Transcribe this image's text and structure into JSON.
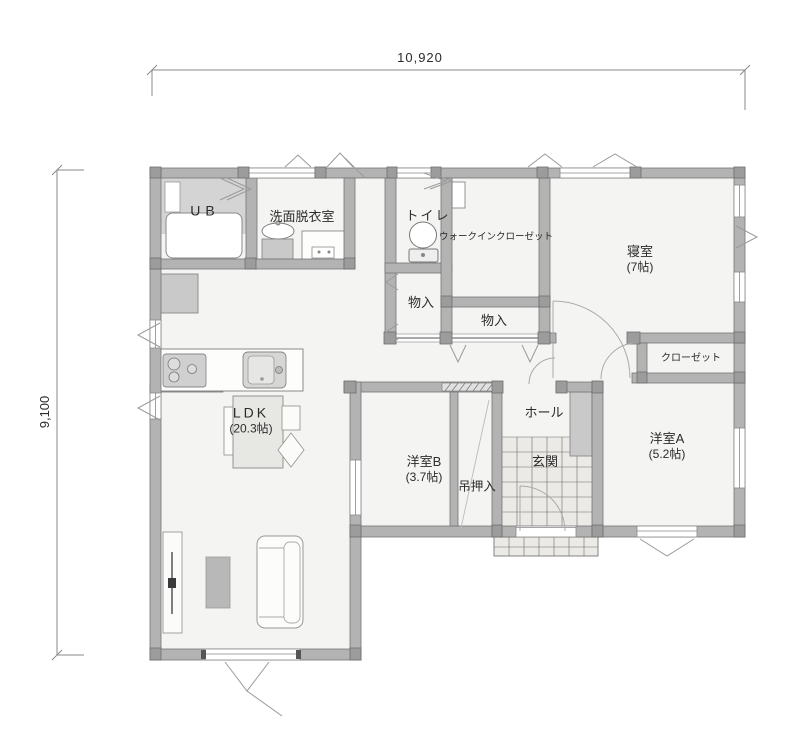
{
  "dimensions": {
    "width": "10,920",
    "height": "9,100"
  },
  "rooms": {
    "ub": {
      "label": "UB"
    },
    "washroom": {
      "label": "洗面脱衣室"
    },
    "toilet": {
      "label": "トイレ"
    },
    "walk_in_closet": {
      "label": "ウォークインクローゼット"
    },
    "bedroom": {
      "label": "寝室",
      "size": "(7帖)"
    },
    "storage_1": {
      "label": "物入"
    },
    "storage_2": {
      "label": "物入"
    },
    "closet": {
      "label": "クローゼット"
    },
    "ldk": {
      "label": "LDK",
      "size": "(20.3帖)"
    },
    "hall": {
      "label": "ホール"
    },
    "entrance": {
      "label": "玄関"
    },
    "hanging_closet": {
      "label": "吊押入"
    },
    "western_room_b": {
      "label": "洋室B",
      "size": "(3.7帖)"
    },
    "western_room_a": {
      "label": "洋室A",
      "size": "(5.2帖)"
    }
  },
  "colors": {
    "wall_fill": "#b3b3b3",
    "wall_outline": "#757575",
    "floor_fill": "#f4f4f2",
    "tile_fill": "#eceae6",
    "fixture_gray": "#c9c9c9",
    "mark_gray": "#9a9a9a",
    "text": "#2b2b2b"
  }
}
